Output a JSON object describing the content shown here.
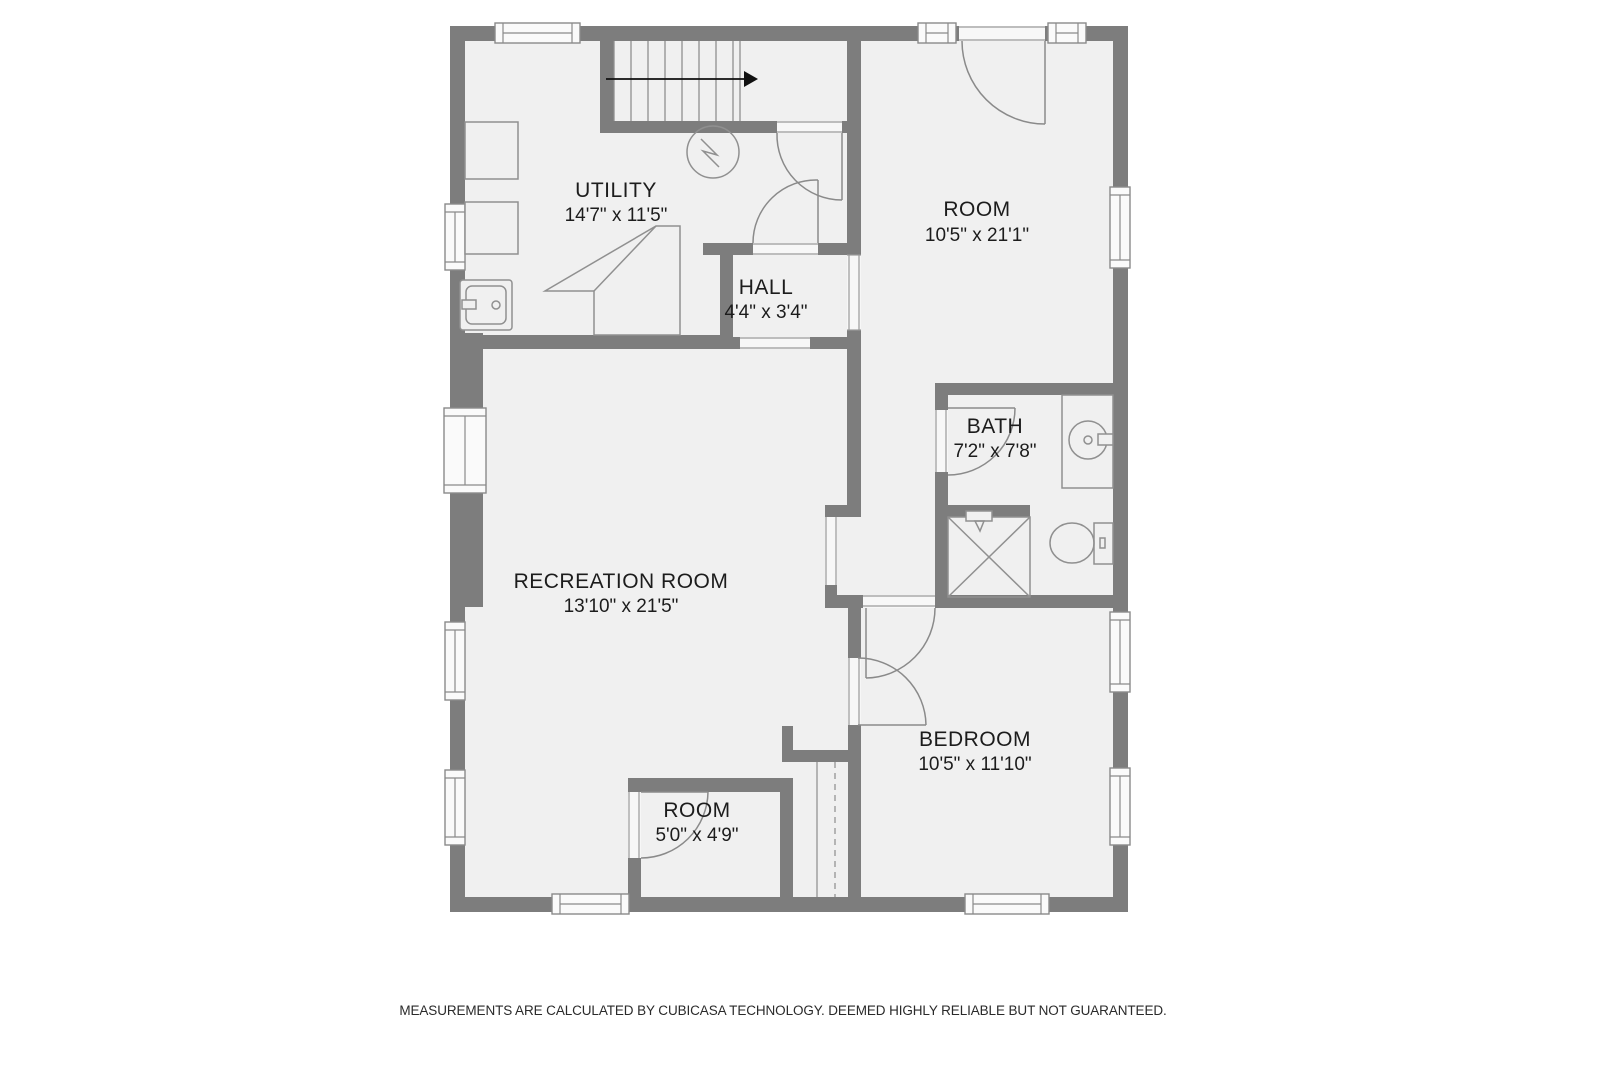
{
  "plan": {
    "rooms": [
      {
        "name": "UTILITY",
        "dims": "14'7\" x 11'5\""
      },
      {
        "name": "ROOM",
        "dims": "10'5\" x 21'1\""
      },
      {
        "name": "HALL",
        "dims": "4'4\" x 3'4\""
      },
      {
        "name": "BATH",
        "dims": "7'2\" x 7'8\""
      },
      {
        "name": "RECREATION ROOM",
        "dims": "13'10\" x 21'5\""
      },
      {
        "name": "BEDROOM",
        "dims": "10'5\" x 11'10\""
      },
      {
        "name": "ROOM",
        "dims": "5'0\" x 4'9\""
      }
    ],
    "colors": {
      "wall": "#7d7d7d",
      "floor": "#f0f0f0",
      "fixture_line": "#909090",
      "text": "#1c1c1c"
    }
  },
  "footer": {
    "disclaimer": "MEASUREMENTS ARE CALCULATED BY CUBICASA TECHNOLOGY. DEEMED HIGHLY RELIABLE BUT NOT GUARANTEED."
  }
}
